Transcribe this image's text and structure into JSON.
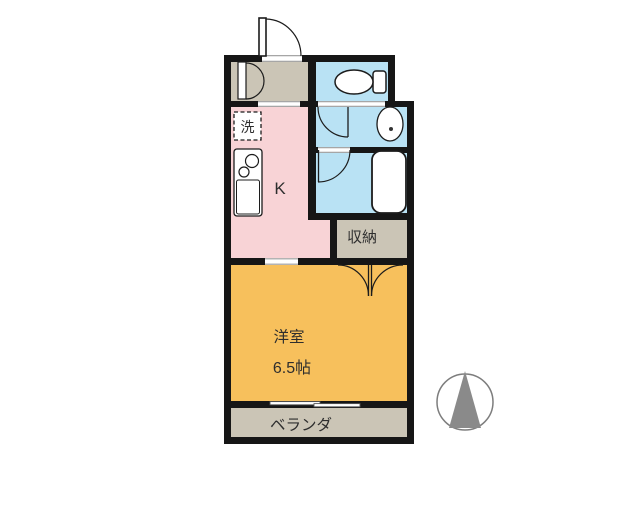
{
  "title": "apartment-floor-plan",
  "labels": {
    "kitchen": "K",
    "laundry": "洗",
    "closet": "収納",
    "main_room_name": "洋室",
    "main_room_size": "6.5帖",
    "balcony": "ベランダ"
  },
  "colors": {
    "kitchen": "#f8d3d6",
    "wet_area": "#b9e2f4",
    "main_room": "#f7c05c",
    "service_area": "#cbc5b6",
    "wall": "#161616",
    "fixture_fill": "#ffffff",
    "compass": "#8a8a8a",
    "text": "#2e2e2e"
  }
}
